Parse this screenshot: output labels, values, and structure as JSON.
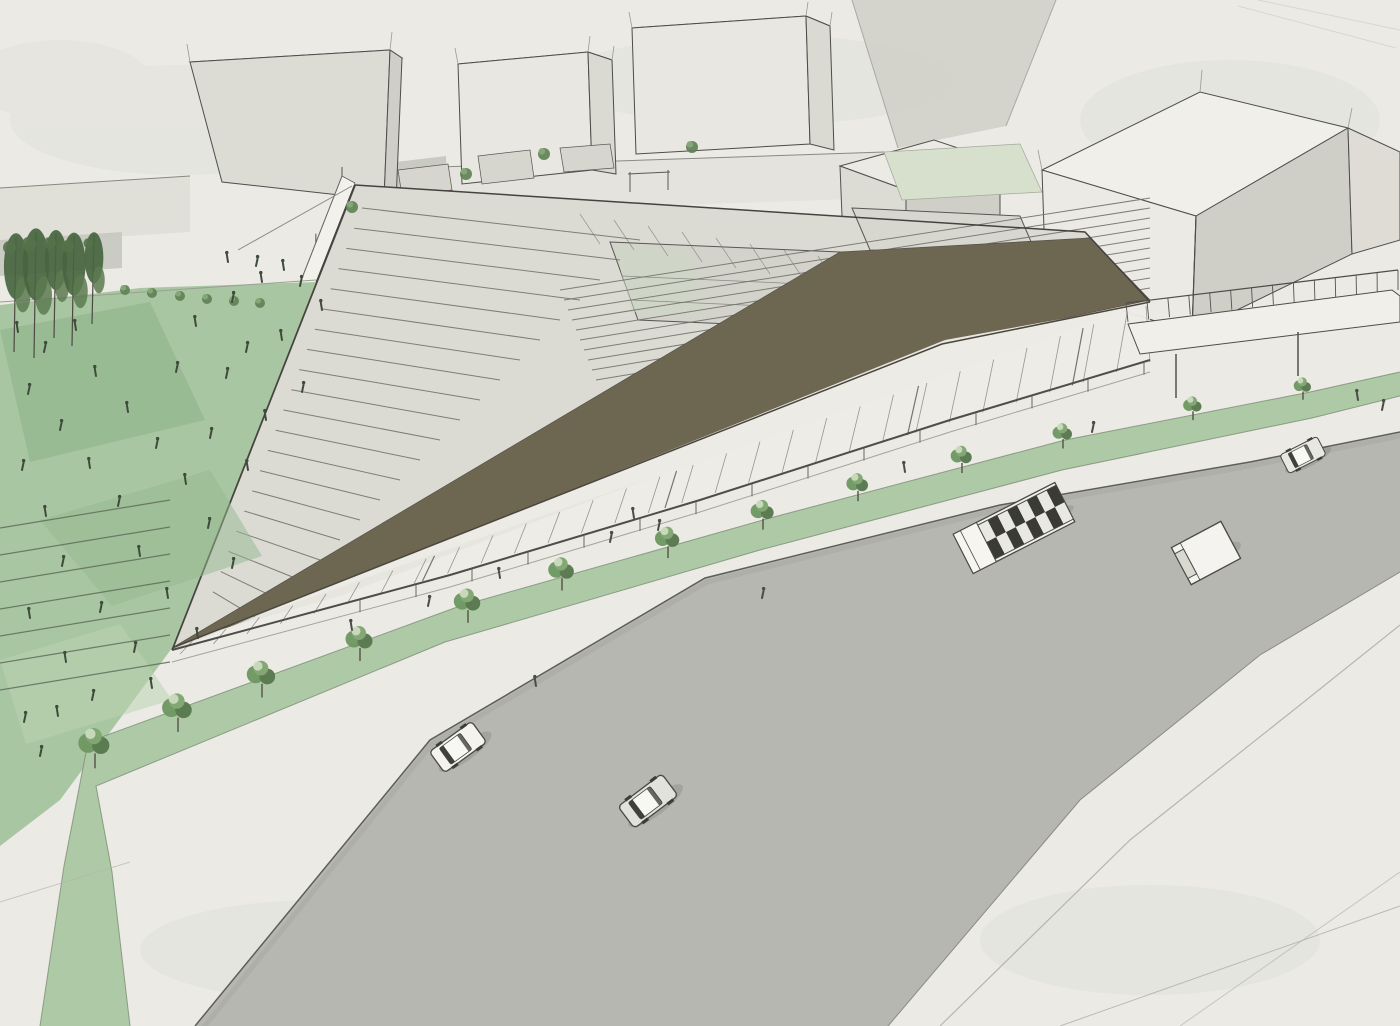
{
  "meta": {
    "kind": "architectural-perspective-rendering",
    "scene_summary": "Aerial sketch rendering of a triangular open-framework building with dark folded roof planes and a glazed sloping facade, flanked by a green public lawn with pedestrians, a tree-lined promenade, and a curved street with vehicles. Background shows simple massing-model buildings."
  },
  "colors": {
    "paper": "#ebeae5",
    "blotch": "#dcdcd6",
    "street": "#b6b7b0",
    "curb": "#5f5f59",
    "curbLight": "#8b8b84",
    "plazaLine": "#b6b6ae",
    "backRoad": "#d0d0c9",
    "lawn": "#a9c6a2",
    "lawnDark": "#8db288",
    "lawnDark2": "#93b78e",
    "lawnLight": "#bcd3b2",
    "strip": "#adc9a6",
    "stripEdge": "#7d8c75",
    "treeDark": "#58784e",
    "treeMid": "#6f9862",
    "treeLight": "#7fa571",
    "treeHi": "#cfdfc2",
    "trunk": "#5a5348",
    "ink": "#4a4a45",
    "inkSoft": "#8a8a84",
    "face": "#dcdcd5",
    "faceLight": "#eceae4",
    "faceTop": "#f0efe9",
    "faceSide": "#cfcfc8",
    "wallBand": "#e0e0d9",
    "wallShade": "#c6c9bf",
    "midSliver": "#c9cac2",
    "paleRoof": "#d6e0cd",
    "roofDark": "#6d6752",
    "roofDark2": "#696350",
    "glass": "#edece6",
    "base": "#dbdad3",
    "court": "#d3d2cb",
    "white": "#f2f1eb",
    "figureLawn": "#3f4b3b",
    "figurePave": "#4c4c47",
    "mullion": "#96958e",
    "shadow": "#000000"
  },
  "structure": {
    "beam_count": 10,
    "rafter_count": 8,
    "step_count": 20,
    "mullion_count": 30,
    "sash_positions": [
      0.25,
      0.5,
      0.75,
      0.92
    ],
    "terrace_line_count": 7,
    "tri2_step_count": 7,
    "wall_post_count": 8,
    "canopy_post_count": 15,
    "walkway_post_count": 14
  },
  "trees": {
    "promenade_row": [
      [
        95,
        758,
        1.15
      ],
      [
        178,
        722,
        1.1
      ],
      [
        262,
        688,
        1.05
      ],
      [
        360,
        652,
        1.0
      ],
      [
        468,
        614,
        0.98
      ],
      [
        562,
        582,
        0.95
      ],
      [
        668,
        550,
        0.9
      ],
      [
        763,
        522,
        0.85
      ],
      [
        858,
        494,
        0.8
      ],
      [
        962,
        466,
        0.78
      ],
      [
        1063,
        442,
        0.72
      ],
      [
        1193,
        414,
        0.68
      ],
      [
        1303,
        394,
        0.64
      ]
    ],
    "left_cluster": [
      [
        14,
        352,
        1.1
      ],
      [
        34,
        358,
        1.2
      ],
      [
        54,
        338,
        1.0
      ],
      [
        72,
        346,
        1.05
      ],
      [
        92,
        324,
        0.85
      ]
    ],
    "walkway_shrubs": [
      [
        125,
        290
      ],
      [
        152,
        293
      ],
      [
        180,
        296
      ],
      [
        207,
        299
      ],
      [
        234,
        301
      ],
      [
        260,
        303
      ]
    ],
    "plaza_shrubs": [
      [
        352,
        207
      ],
      [
        466,
        174
      ],
      [
        544,
        154
      ],
      [
        692,
        147
      ]
    ]
  },
  "people": {
    "lawn": [
      [
        18,
        332
      ],
      [
        44,
        352
      ],
      [
        76,
        330
      ],
      [
        28,
        394
      ],
      [
        96,
        376
      ],
      [
        60,
        430
      ],
      [
        128,
        412
      ],
      [
        22,
        470
      ],
      [
        90,
        468
      ],
      [
        156,
        448
      ],
      [
        46,
        516
      ],
      [
        118,
        506
      ],
      [
        186,
        484
      ],
      [
        62,
        566
      ],
      [
        140,
        556
      ],
      [
        208,
        528
      ],
      [
        30,
        618
      ],
      [
        100,
        612
      ],
      [
        168,
        598
      ],
      [
        232,
        568
      ],
      [
        66,
        662
      ],
      [
        134,
        652
      ],
      [
        198,
        638
      ],
      [
        92,
        700
      ],
      [
        152,
        688
      ],
      [
        246,
        352
      ],
      [
        282,
        340
      ],
      [
        226,
        378
      ],
      [
        266,
        420
      ],
      [
        302,
        392
      ],
      [
        196,
        326
      ],
      [
        232,
        302
      ],
      [
        262,
        282
      ],
      [
        300,
        286
      ],
      [
        322,
        310
      ],
      [
        210,
        438
      ],
      [
        248,
        470
      ],
      [
        176,
        372
      ],
      [
        228,
        262
      ],
      [
        256,
        266
      ],
      [
        284,
        270
      ],
      [
        24,
        722
      ],
      [
        58,
        716
      ],
      [
        40,
        756
      ]
    ],
    "pavement": [
      [
        352,
        630
      ],
      [
        428,
        606
      ],
      [
        500,
        578
      ],
      [
        610,
        542
      ],
      [
        634,
        518
      ],
      [
        658,
        530
      ],
      [
        536,
        686
      ],
      [
        762,
        598
      ],
      [
        905,
        472
      ],
      [
        1092,
        432
      ],
      [
        1358,
        400
      ],
      [
        1382,
        410
      ]
    ]
  },
  "vehicles": [
    {
      "type": "car",
      "x": 458,
      "y": 747,
      "angle": -36,
      "s": 1.0,
      "body": "#f4f3ef"
    },
    {
      "type": "car",
      "x": 648,
      "y": 801,
      "angle": -37,
      "s": 1.05,
      "body": "#e2e2dc"
    },
    {
      "type": "bus",
      "x": 1014,
      "y": 528,
      "angle": -27,
      "s": 1.0,
      "body": "#f2f1ec"
    },
    {
      "type": "boxtruck",
      "x": 1206,
      "y": 553,
      "angle": -28,
      "s": 1.0,
      "body": "#f4f3ef"
    },
    {
      "type": "car",
      "x": 1303,
      "y": 455,
      "angle": -27,
      "s": 0.8,
      "body": "#e8e8e2"
    }
  ]
}
